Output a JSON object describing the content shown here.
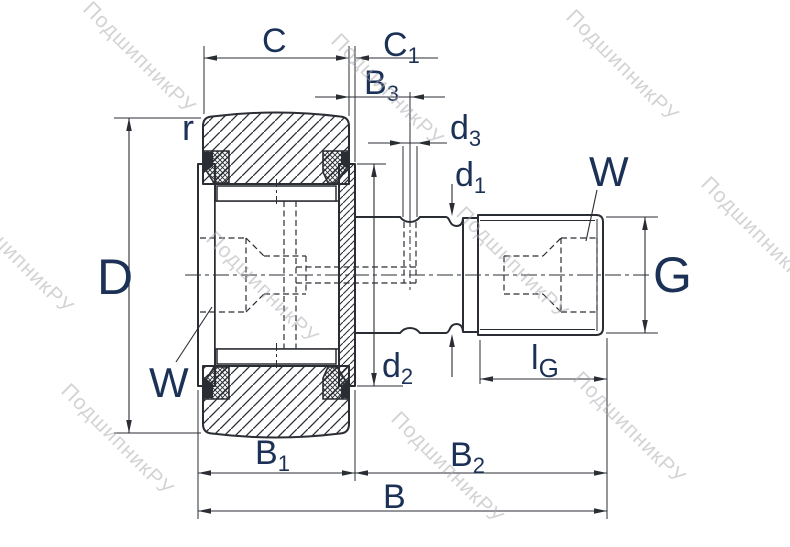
{
  "drawing": {
    "type": "bearing-technical-drawing",
    "watermark": {
      "text": "ПодшипникРУ"
    },
    "colors": {
      "line": "#2a2d33",
      "label": "#1c3156",
      "watermark": "#a9a9ae",
      "background": "#ffffff"
    },
    "dims": {
      "c": {
        "main": "C",
        "sub": ""
      },
      "c1": {
        "main": "C",
        "sub": "1"
      },
      "b3": {
        "main": "B",
        "sub": "3"
      },
      "d3": {
        "main": "d",
        "sub": "3"
      },
      "d1": {
        "main": "d",
        "sub": "1"
      },
      "d2": {
        "main": "d",
        "sub": "2"
      },
      "w_top": {
        "main": "W",
        "sub": ""
      },
      "w_left": {
        "main": "W",
        "sub": ""
      },
      "r": {
        "main": "r",
        "sub": ""
      },
      "big_d": {
        "main": "D",
        "sub": ""
      },
      "g": {
        "main": "G",
        "sub": ""
      },
      "lg": {
        "main": "l",
        "sub": "G"
      },
      "b1": {
        "main": "B",
        "sub": "1"
      },
      "b2": {
        "main": "B",
        "sub": "2"
      },
      "b": {
        "main": "B",
        "sub": ""
      }
    }
  }
}
